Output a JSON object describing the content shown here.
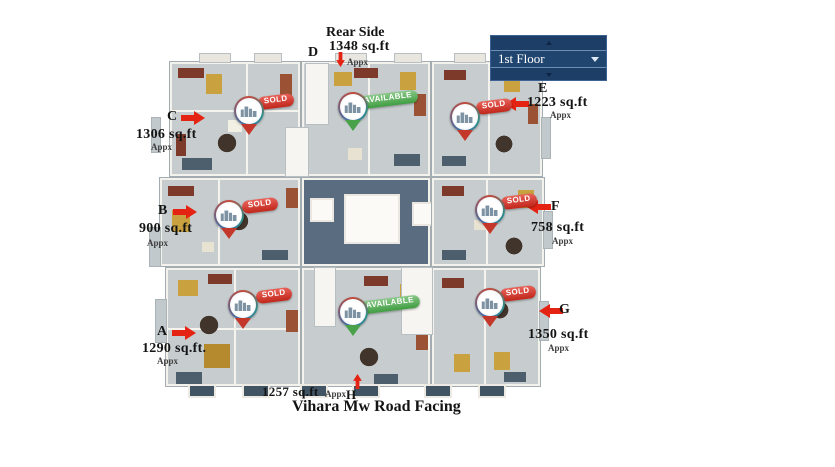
{
  "floor_selector": {
    "selected_option": "1st Floor",
    "caret_icon": "caret-down",
    "scroll_up_icon": "caret-up",
    "scroll_down_icon": "caret-down"
  },
  "orientation": {
    "rear_label": "Rear Side",
    "front_label": "Vihara Mw Road Facing"
  },
  "units": [
    {
      "letter": "A",
      "area": "1290 sq.ft.",
      "approx": "Appx",
      "status": "SOLD"
    },
    {
      "letter": "B",
      "area": "900 sq.ft",
      "approx": "Appx",
      "status": "SOLD"
    },
    {
      "letter": "C",
      "area": "1306 sq.ft",
      "approx": "Appx",
      "status": "SOLD"
    },
    {
      "letter": "D",
      "area": "1348 sq.ft",
      "approx": "Appx",
      "status": "AVAILABLE"
    },
    {
      "letter": "E",
      "area": "1223 sq.ft",
      "approx": "Appx",
      "status": "SOLD"
    },
    {
      "letter": "F",
      "area": "758 sq.ft",
      "approx": "Appx",
      "status": "SOLD"
    },
    {
      "letter": "G",
      "area": "1350 sq.ft",
      "approx": "Appx",
      "status": "SOLD"
    },
    {
      "letter": "H",
      "area": "1257 sq.ft",
      "approx": "Appx",
      "status": "AVAILABLE"
    }
  ],
  "colors": {
    "sold_badge": "#c8281c",
    "available_badge": "#44a046",
    "arrow_red": "#e42313",
    "selector_navy": "#1d3e66",
    "pin_building_icon": "#7d93a3"
  }
}
